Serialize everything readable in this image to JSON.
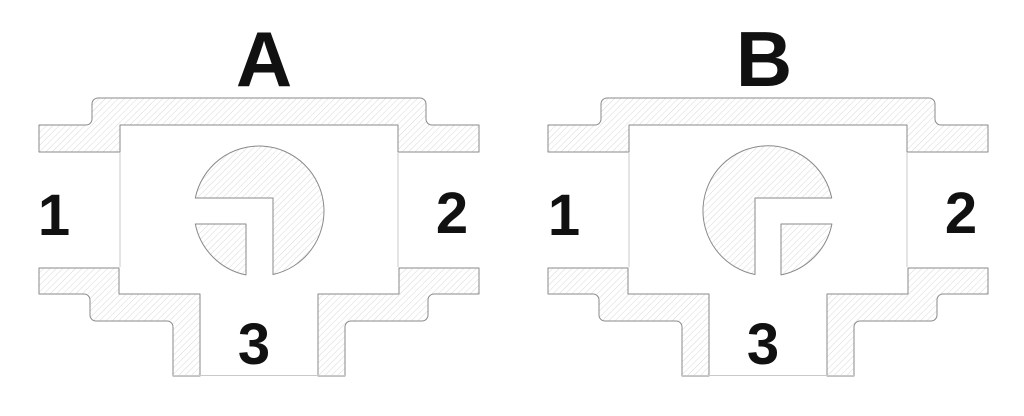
{
  "figure": {
    "type": "technical-section-diagram",
    "subject": "Three-way L-port ball valve cross-sections shown in two switching positions"
  },
  "colors": {
    "bg": "#ffffff",
    "outline": "#8a8a8a",
    "hatch": "#d9d9d9",
    "faint": "#c9c9c9",
    "ink": "#111111"
  },
  "diagrams": [
    {
      "title": "A",
      "position_note": "ball L-passage opens to left and bottom ports",
      "ports": [
        {
          "label": "1"
        },
        {
          "label": "2"
        },
        {
          "label": "3"
        }
      ]
    },
    {
      "title": "B",
      "position_note": "ball L-passage opens to right and bottom ports",
      "ports": [
        {
          "label": "1"
        },
        {
          "label": "2"
        },
        {
          "label": "3"
        }
      ]
    }
  ]
}
